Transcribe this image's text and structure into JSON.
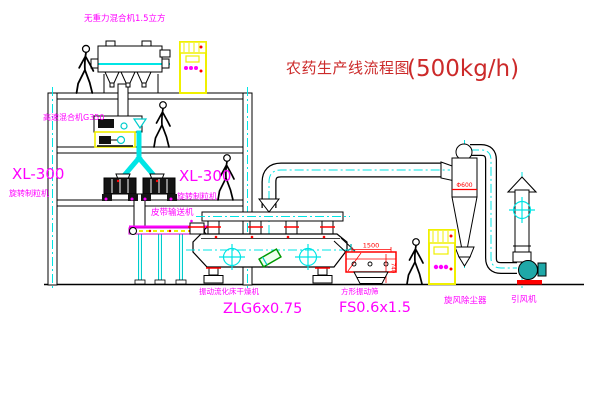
{
  "title": {
    "name": "农药生产线流程图",
    "capacity": "(500kg/h)"
  },
  "equipment_labels": {
    "gravity_mixer": "无重力混合机1.5立方",
    "high_speed_mixer": "高速混合机G350",
    "granulator_model": "XL-300",
    "granulator_name": "旋转制粒机",
    "belt_conveyor": "皮带输送机",
    "dryer_name": "振动流化床干燥机",
    "dryer_model": "ZLG6x0.75",
    "screen_name": "方形振动筛",
    "screen_model": "FS0.6x1.5",
    "cyclone": "旋风除尘器",
    "induced_draft_fan": "引风机"
  },
  "dimensions": {
    "screen_length": "1500",
    "screen_height": "740",
    "cyclone_diameter": "Φ600"
  },
  "colors": {
    "label_magenta": "#FF00FF",
    "title_red": "#CC2A2A",
    "line_black": "#000000",
    "centerline_cyan": "#00E5E5",
    "cabinet_yellow": "#F0F000",
    "alert_red": "#FF0000",
    "fan_teal": "#1FA8A8",
    "canister_green": "#009900"
  }
}
